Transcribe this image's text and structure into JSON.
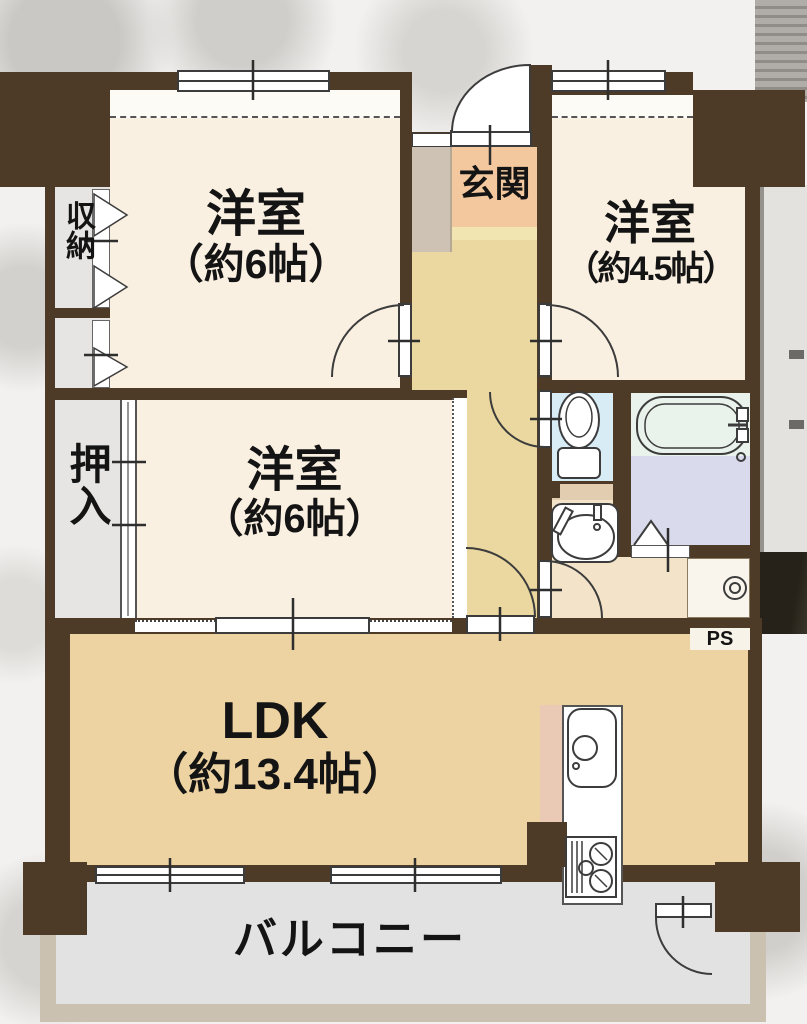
{
  "floorplan": {
    "genkan": {
      "label": "玄関"
    },
    "bedroom1": {
      "label": "洋室",
      "size": "（約6帖）"
    },
    "bedroom2": {
      "label": "洋室",
      "size": "（約4.5帖）"
    },
    "bedroom3": {
      "label": "洋室",
      "size": "（約6帖）"
    },
    "ldk": {
      "label": "LDK",
      "size": "（約13.4帖）"
    },
    "storage": {
      "label": "収納"
    },
    "oshiire": {
      "label": "押入"
    },
    "balcony": {
      "label": "バルコニー"
    },
    "pipe_space": {
      "label": "PS"
    },
    "colors": {
      "wall": "#4e3b27",
      "bedroom_floor": "#faf0e2",
      "hallway_floor": "#ead8a0",
      "genkan_floor": "#f4c89e",
      "ldk_floor": "#edd2a2",
      "storage_floor": "#e6e5e3",
      "toilet_floor": "#d8ecf6",
      "bath_floor": "#d9dbec",
      "washroom_floor": "#f2e3c9",
      "balcony_floor": "#e2e2e3"
    }
  }
}
